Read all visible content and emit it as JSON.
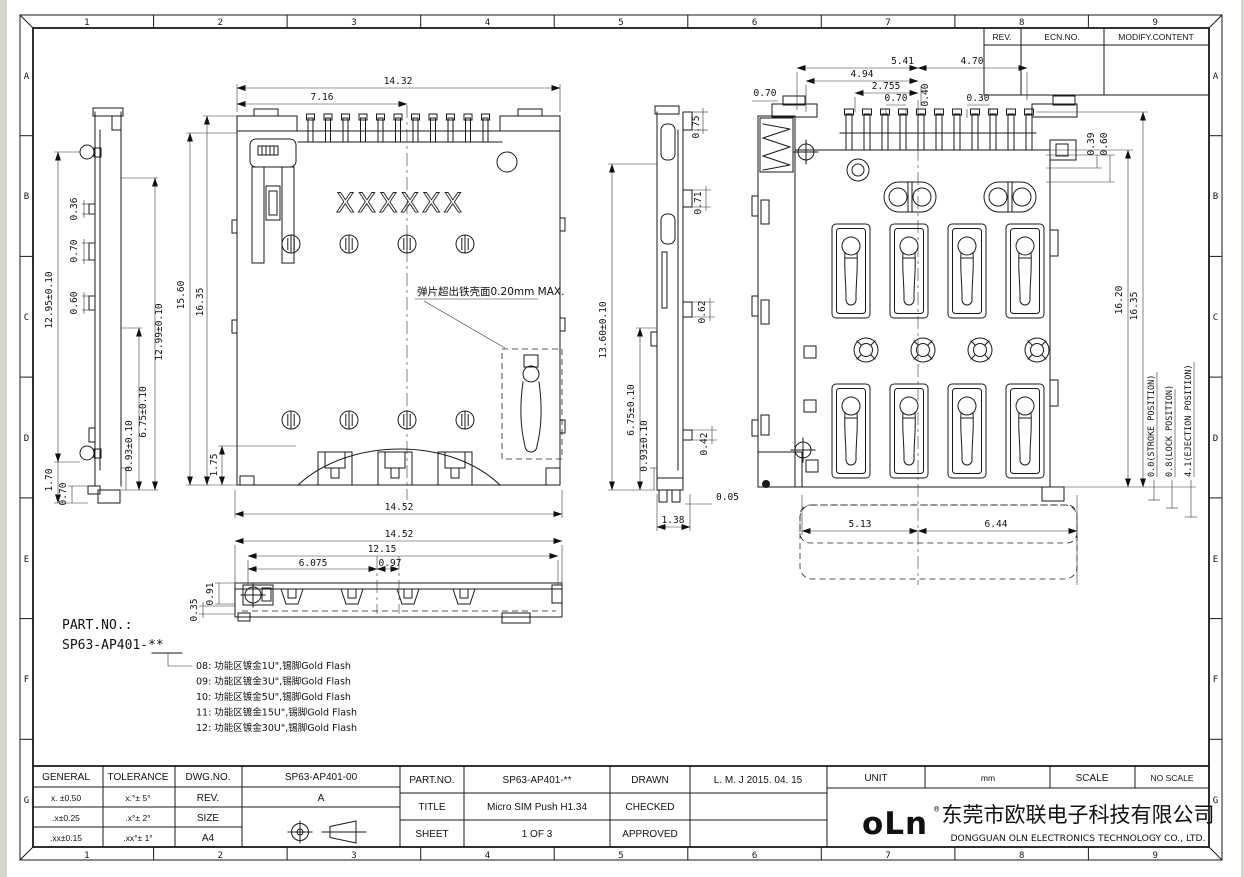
{
  "ecn_table": {
    "rev_label": "REV.",
    "ecn_label": "ECN.NO.",
    "modify_label": "MODIFY.CONTENT"
  },
  "border": {
    "cols": [
      "1",
      "2",
      "3",
      "4",
      "5",
      "6",
      "7",
      "8",
      "9"
    ],
    "rows": [
      "A",
      "B",
      "C",
      "D",
      "E",
      "F",
      "G"
    ]
  },
  "part_note": {
    "label": "PART.NO.:",
    "part_no": "SP63-AP401-**",
    "options": [
      "08: 功能区镀金1U\",锡脚Gold Flash",
      "09: 功能区镀金3U\",锡脚Gold Flash",
      "10: 功能区镀金5U\",锡脚Gold Flash",
      "11: 功能区镀金15U\",锡脚Gold Flash",
      "12: 功能区镀金30U\",锡脚Gold Flash"
    ]
  },
  "views": {
    "top": {
      "marking": "XXXXXX",
      "note": "弹片超出铁壳面0.20mm MAX.",
      "dims": {
        "w_top": "14.32",
        "w_half": "7.16",
        "h_left": "15.60",
        "h_left2": "16.35",
        "t175": "1.75",
        "w_bot": "14.52"
      }
    },
    "side_left": {
      "dims": {
        "h_overall": "12.95±0.10",
        "t036": "0.36",
        "t070": "0.70",
        "t060": "0.60",
        "h_inner": "12.99±0.10",
        "t675": "6.75±0.10",
        "t093": "0.93±0.10",
        "t170": "1.70",
        "b070": "0.70"
      }
    },
    "side_mid": {
      "dims": {
        "h_overall": "13.60±0.10",
        "t675": "6.75±0.10",
        "t093": "0.93±0.10",
        "t075": "0.75",
        "t071": "0.71",
        "t062": "0.62",
        "t042": "0.42",
        "t005": "0.05",
        "t138": "1.38"
      }
    },
    "bottom": {
      "dims": {
        "w1": "14.52",
        "w2": "12.15",
        "w3": "6.075",
        "w4": "0.97",
        "h091": "0.91",
        "h035": "0.35"
      }
    },
    "back": {
      "dims": {
        "t541": "5.41",
        "t494": "4.94",
        "t2755": "2.755",
        "t070": "0.70",
        "t040": "0.40",
        "t470": "4.70",
        "t030": "0.30",
        "l070": "0.70",
        "t039": "0.39",
        "t060": "0.60",
        "h1620": "16.20",
        "h1635": "16.35",
        "b513": "5.13",
        "b644": "6.44",
        "stroke_pos": "0.0(STROKE POSITION)",
        "lock_pos": "0.8(LOCK POSITION)",
        "eject_pos": "4.1(EJECTION POSITION)"
      }
    }
  },
  "title_block": {
    "general_label": "GENERAL",
    "tolerance_label": "TOLERANCE",
    "tol_lin": [
      "x. ±0.50",
      ".x±0.25",
      ".xx±0.15"
    ],
    "tol_ang": [
      "x.°± 5°",
      ".x°± 2°",
      ".xx°± 1°"
    ],
    "dwg_label": "DWG.NO.",
    "dwg_no": "SP63-AP401-00",
    "rev_label": "REV.",
    "rev": "A",
    "size_label": "SIZE",
    "size": "A4",
    "part_label": "PART.NO.",
    "part_no": "SP63-AP401-**",
    "title_label": "TITLE",
    "title": "Micro SIM Push H1.34",
    "sheet_label": "SHEET",
    "sheet": "1 OF 3",
    "drawn_label": "DRAWN",
    "drawn": "L. M. J 2015. 04. 15",
    "checked_label": "CHECKED",
    "checked": "",
    "approved_label": "APPROVED",
    "approved": "",
    "unit_label": "UNIT",
    "unit": "mm",
    "scale_label": "SCALE",
    "scale": "NO SCALE",
    "logo": "oLn",
    "logo_reg": "®",
    "company_cn": "东莞市欧联电子科技有限公司",
    "company_en": "DONGGUAN OLN ELECTRONICS TECHNOLOGY CO., LTD."
  }
}
